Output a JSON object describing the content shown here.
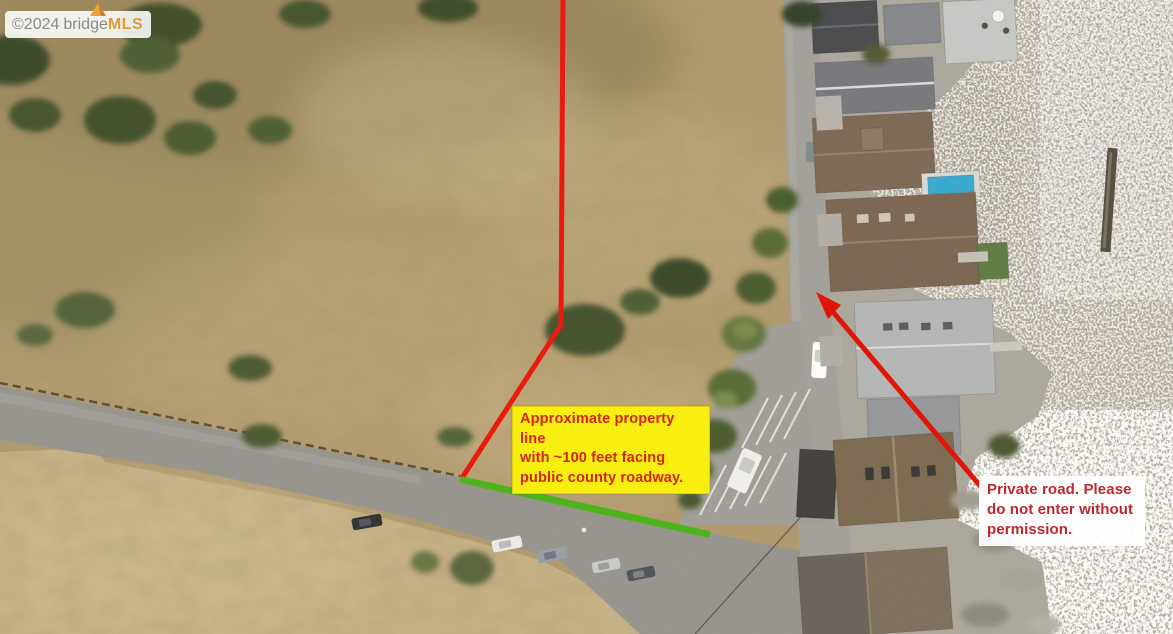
{
  "watermark": {
    "copyright_year": "©2024",
    "brand_first": "bridge",
    "brand_second": "MLS"
  },
  "annotations": {
    "property_line": {
      "text": "Approximate property line\nwith ~100 feet facing\npublic county roadway.",
      "background": "#f8ee10",
      "text_color": "#d3261a"
    },
    "private_road": {
      "text": "Private road. Please\ndo not enter without\npermission.",
      "background": "#ffffff",
      "text_color": "#c0272d"
    }
  },
  "overlays": {
    "property_line_color": "#ea1a0c",
    "road_frontage_color": "#4db41d",
    "arrow_color": "#e01508"
  }
}
